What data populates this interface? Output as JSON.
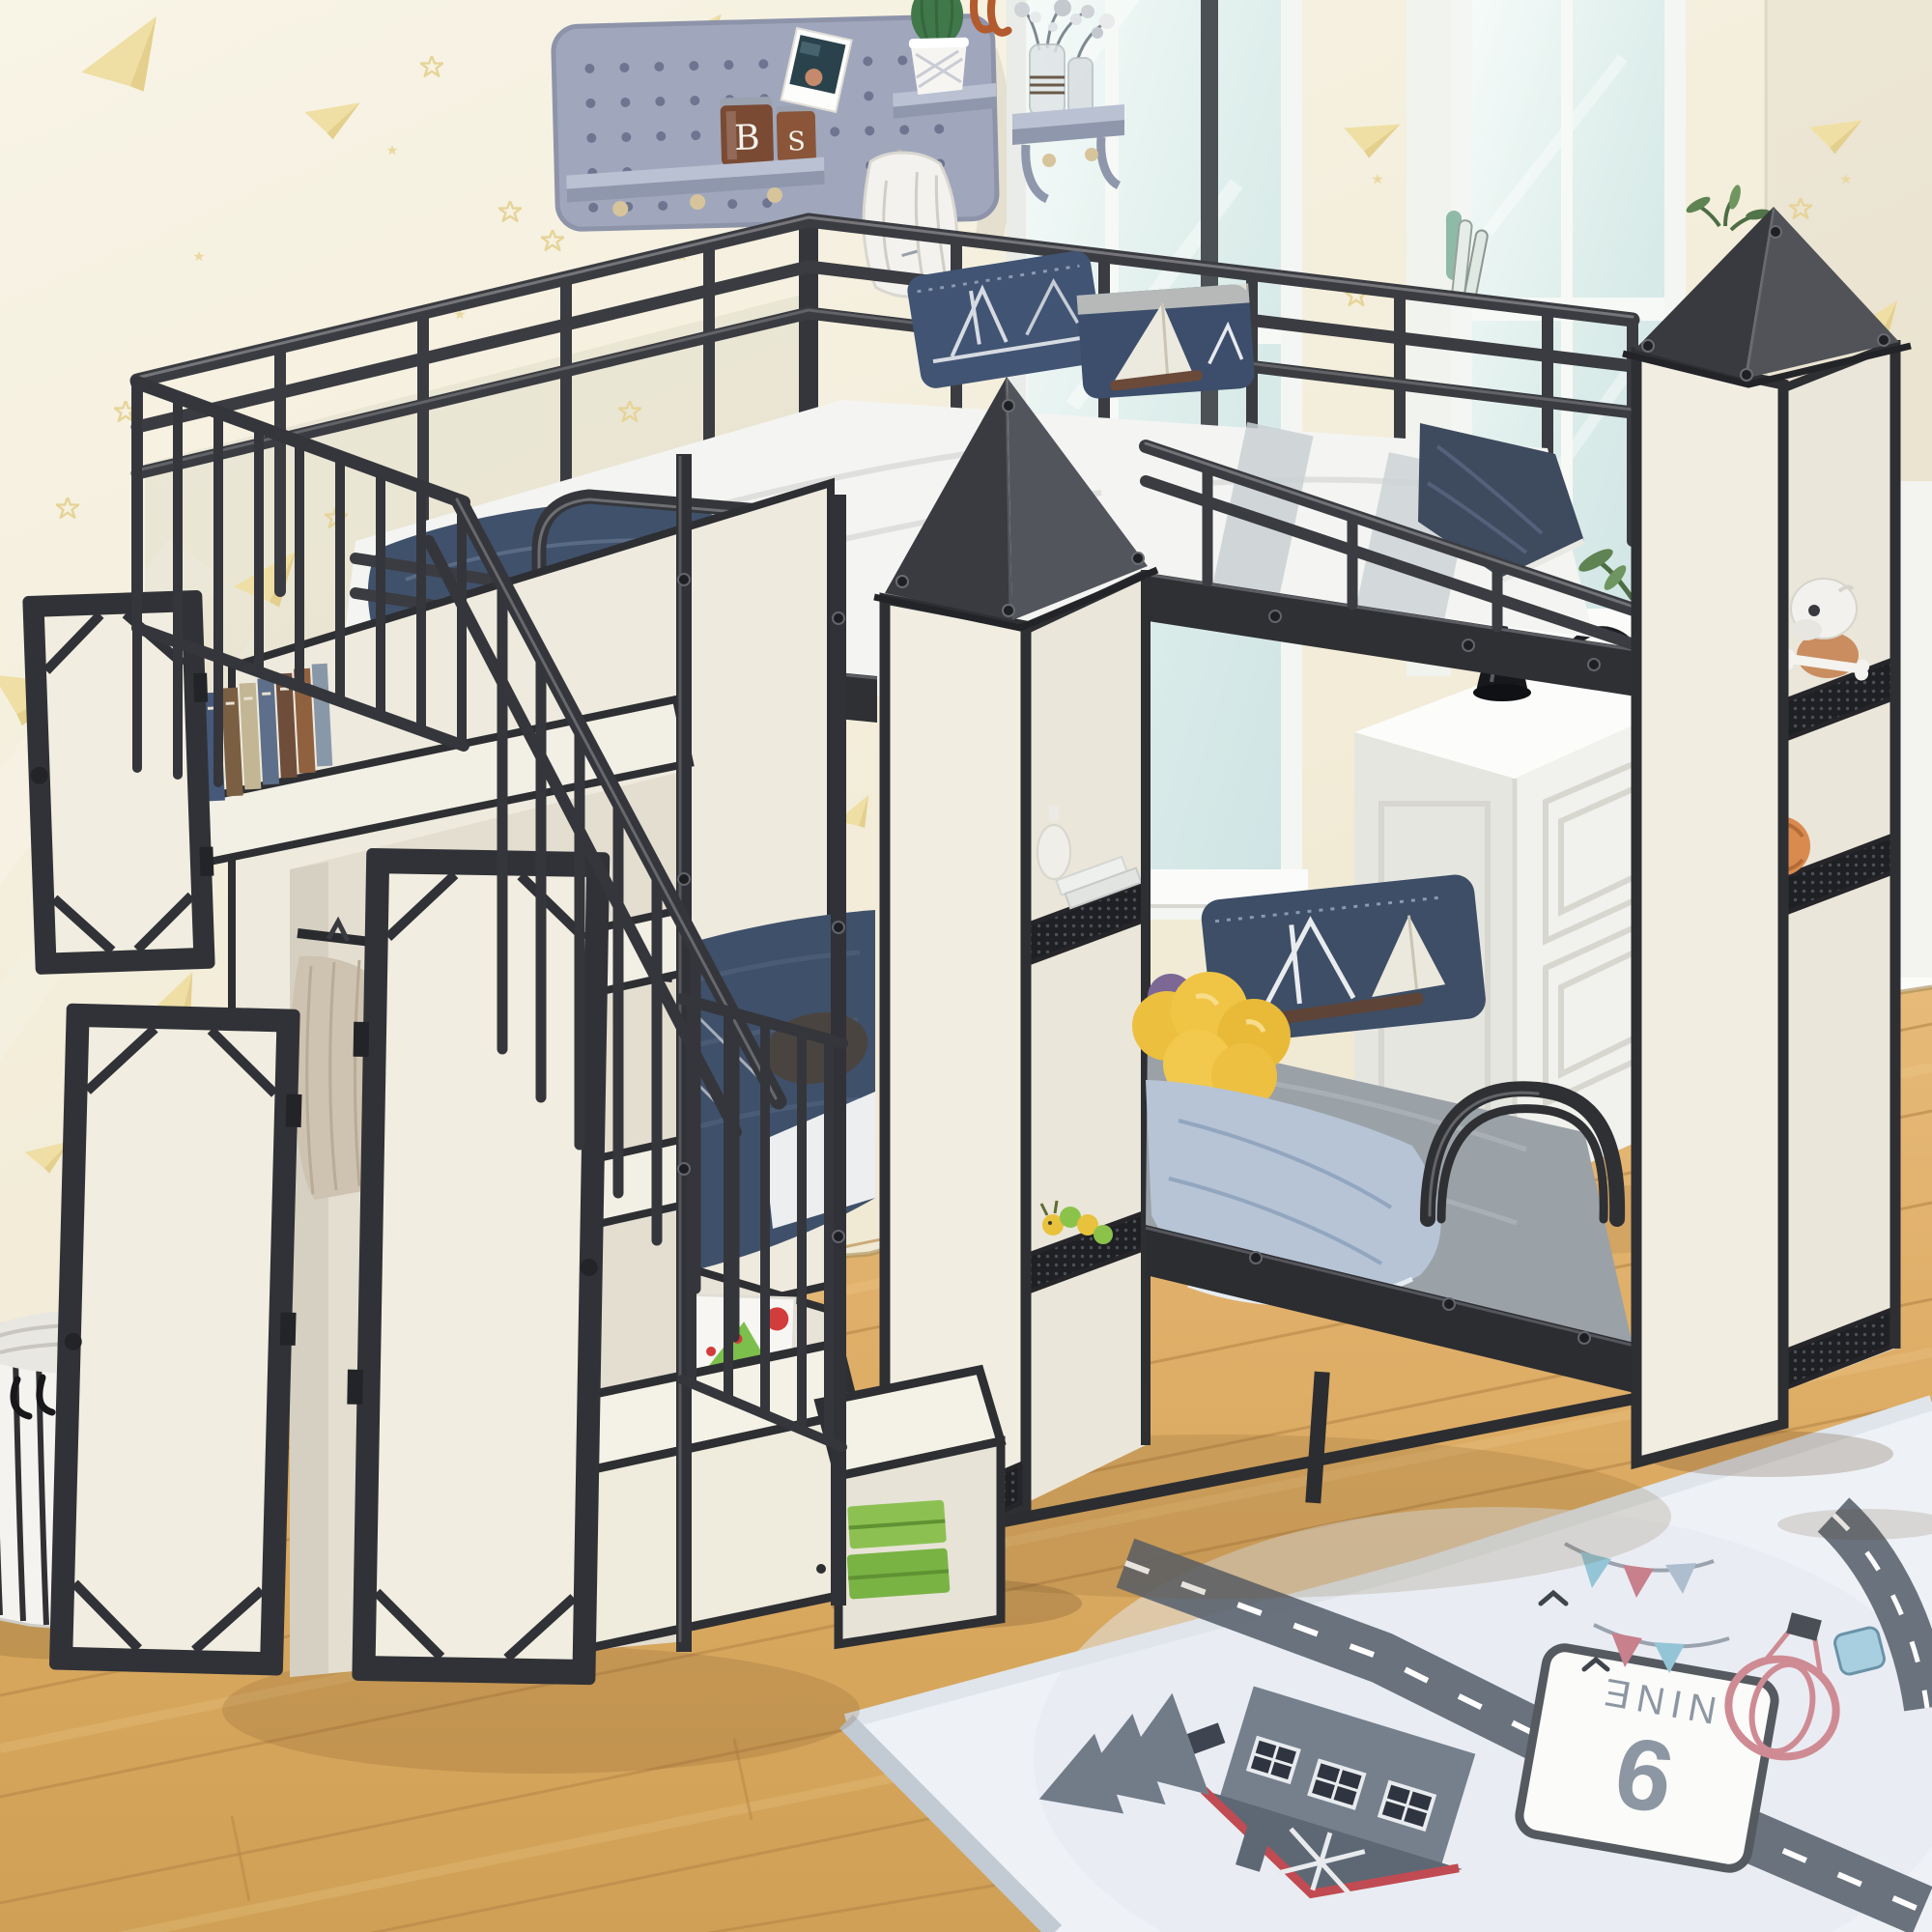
{
  "page": {
    "title": "Kids bedroom product photo: black metal castle-themed twin-over-twin bunk bed with storage staircase, wardrobe, towers with shelves, play rug and laundry basket"
  },
  "palette": {
    "metal_frame": "#3b3c41",
    "panel_cream": "#f1ede1",
    "wall_cream": "#f5f0dd",
    "pattern_yellow": "#e9d79b",
    "floor_wood": "#dcab63",
    "bedding_navy": "#3f506a",
    "bedding_gray": "#9aa1a7",
    "bedding_lightblue": "#b6c4d6",
    "plush_yellow": "#eec041",
    "rug_base": "#eef1f5",
    "rug_road": "#5b6470",
    "storage_green": "#8cc152",
    "pegboard_gray": "#9aa1b8",
    "window_glass": "#dcedea"
  },
  "pegboard": {
    "jar_letters": [
      "B",
      "S"
    ]
  },
  "rug_sign": {
    "number": "9",
    "word": "NINE"
  },
  "scene_items": [
    "wallpaper with paper airplanes and stars",
    "gray pegboard with shelf, jars, polaroid, cactus, hanging bag",
    "wall shelf with glass vase of dried flowers",
    "two white-framed windows with handle",
    "black metal bunk bed with cream panels",
    "two castle towers with dark pyramid roofs and mesh shelves",
    "staircase with railings and under-stair storage",
    "open wardrobe with doors, hanging clothes, shoes, books",
    "upper bunk white bedding, navy sailboat pillows, blue pillow",
    "lower bunk gray sheet, navy sailboat pillow, yellow flower plush, blue blanket",
    "white dresser with black cone lamp and headphones",
    "skull toy figure and orange ball on tower shelves",
    "white laundry basket with black stripes",
    "wooden plank floor",
    "play rug with road, house, pine tree, balloon, pennants and NINE sign",
    "green storage drawers and toy box"
  ]
}
